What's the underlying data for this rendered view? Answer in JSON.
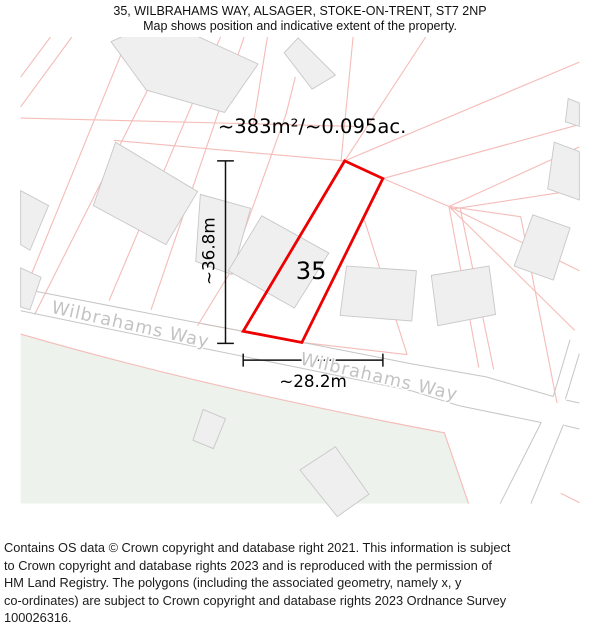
{
  "header": {
    "title": "35, WILBRAHAMS WAY, ALSAGER, STOKE-ON-TRENT, ST7 2NP",
    "subtitle": "Map shows position and indicative extent of the property."
  },
  "map": {
    "area_label": "~383m²/~0.095ac.",
    "plot_number": "35",
    "width_label": "~28.2m",
    "depth_label": "~36.8m",
    "street_labels": {
      "left": "Wilbrahams Way",
      "right": "Wilbrahams Way"
    },
    "colors": {
      "property_outline": "#ee0000",
      "parcel_boundary": "#f5bcb8",
      "building_fill": "#f0eff0",
      "building_stroke": "#c9c9c9",
      "road_casing": "#c6c6c6",
      "greenspace": "#edf2ec",
      "street_label_text": "#c3c3c3",
      "dimension_lines": "#111111"
    }
  },
  "footer": {
    "lines": [
      "Contains OS data © Crown copyright and database right 2021. This information is subject",
      "to Crown copyright and database rights 2023 and is reproduced with the permission of",
      "HM Land Registry. The polygons (including the associated geometry, namely x, y",
      "co-ordinates) are subject to Crown copyright and database rights 2023 Ordnance Survey",
      "100026316."
    ]
  }
}
